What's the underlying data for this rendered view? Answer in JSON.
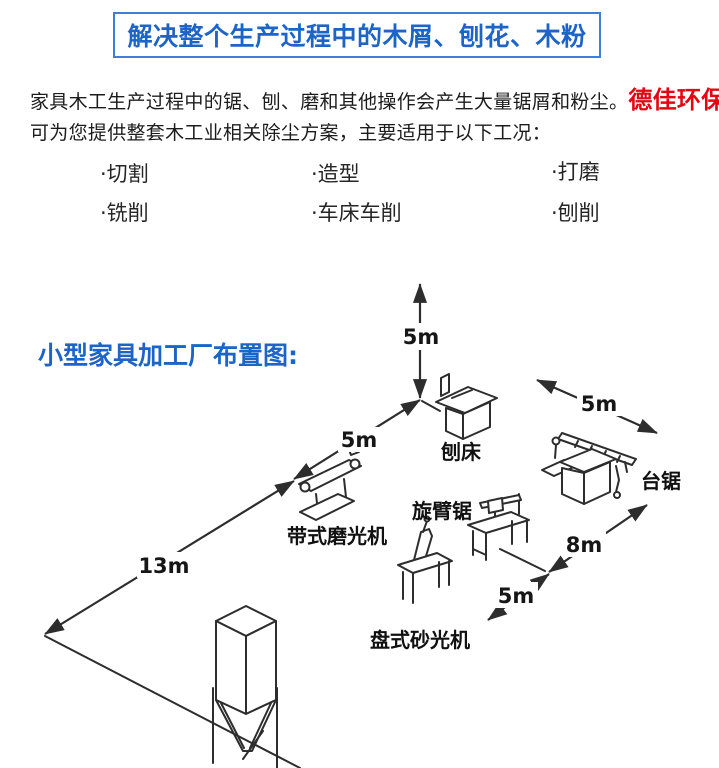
{
  "header": {
    "title": "解决整个生产过程中的木屑、刨花、木粉"
  },
  "intro": {
    "line1": "家具木工生产过程中的锯、刨、磨和其他操作会产生大量锯屑和粉尘。",
    "company": "德佳环保",
    "line2": "可为您提供整套木工业相关除尘方案，主要适用于以下工况："
  },
  "conditions": {
    "items": [
      {
        "label": "·切割"
      },
      {
        "label": "·造型"
      },
      {
        "label": "·打磨"
      },
      {
        "label": "·铣削"
      },
      {
        "label": "·车床车削"
      },
      {
        "label": "·刨削"
      }
    ]
  },
  "diagram": {
    "title": "小型家具加工厂布置图:",
    "dimensions": {
      "height": "5m",
      "left_upper": "5m",
      "left_lower": "13m",
      "top_right": "5m",
      "right_upper": "8m",
      "right_lower": "5m"
    },
    "machines": [
      {
        "label": "刨床"
      },
      {
        "label": "台锯"
      },
      {
        "label": "带式磨光机"
      },
      {
        "label": "旋臂锯"
      },
      {
        "label": "盘式砂光机"
      }
    ]
  },
  "colors": {
    "accent_blue": "#1c64c8",
    "accent_red": "#e30613",
    "line_color": "#2d2d2d"
  }
}
